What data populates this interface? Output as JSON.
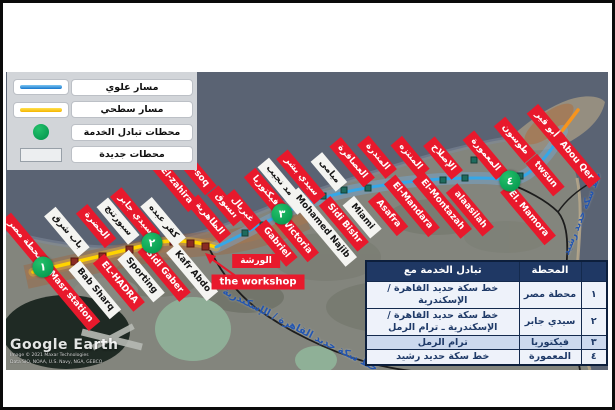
{
  "legend": {
    "items": [
      {
        "label": "مسار علوي",
        "symbol": "elevated-line"
      },
      {
        "label": "مسار سطحي",
        "symbol": "surface-line"
      },
      {
        "label": "محطات تبادل الخدمة",
        "symbol": "interchange-circle"
      },
      {
        "label": "محطات جديدة",
        "symbol": "new-station-box"
      }
    ]
  },
  "stations": [
    {
      "name_ar": "محطة مصر",
      "name_en": "Masr station",
      "type": "existing",
      "ar_pos": [
        19,
        169
      ],
      "en_pos": [
        64,
        225
      ]
    },
    {
      "name_ar": "باب شرق",
      "name_en": "Bab Sharq",
      "type": "new",
      "ar_pos": [
        61,
        160
      ],
      "en_pos": [
        89,
        218
      ]
    },
    {
      "name_ar": "الحضرة",
      "name_en": "EL-HADRA",
      "type": "existing",
      "ar_pos": [
        90,
        154
      ],
      "en_pos": [
        113,
        211
      ]
    },
    {
      "name_ar": "سبورتنج",
      "name_en": "Sporting",
      "type": "new",
      "ar_pos": [
        112,
        149
      ],
      "en_pos": [
        135,
        204
      ]
    },
    {
      "name_ar": "سيدي جابر",
      "name_en": "Sidi Gaber",
      "type": "existing",
      "ar_pos": [
        129,
        143
      ],
      "en_pos": [
        158,
        200
      ]
    },
    {
      "name_ar": "كفر عبده",
      "name_en": "Kafr Abdo",
      "type": "new",
      "ar_pos": [
        157,
        150
      ],
      "en_pos": [
        186,
        200
      ]
    },
    {
      "name_ar": "الظاهرية",
      "name_en": "El-zahira",
      "type": "existing",
      "ar_pos": [
        203,
        147
      ],
      "en_pos": [
        170,
        114
      ]
    },
    {
      "name_ar": "السوق",
      "name_en": "El-soq",
      "type": "existing",
      "ar_pos": [
        220,
        134
      ],
      "en_pos": [
        191,
        102
      ]
    },
    {
      "name_ar": "غبريال",
      "name_en": "Gabriel",
      "type": "existing",
      "ar_pos": [
        236,
        138
      ],
      "en_pos": [
        270,
        171
      ]
    },
    {
      "name_ar": "فيكتوريا",
      "name_en": "Victoria",
      "type": "existing",
      "ar_pos": [
        259,
        119
      ],
      "en_pos": [
        291,
        166
      ]
    },
    {
      "name_ar": "محمد نجيب",
      "name_en": "Mohamed Najib",
      "type": "new",
      "ar_pos": [
        277,
        114
      ],
      "en_pos": [
        316,
        155
      ]
    },
    {
      "name_ar": "سيدي بشر",
      "name_en": "Sidi Bishr",
      "type": "existing",
      "ar_pos": [
        295,
        105
      ],
      "en_pos": [
        338,
        152
      ]
    },
    {
      "name_ar": "ميامى",
      "name_en": "Miami",
      "type": "new",
      "ar_pos": [
        323,
        100
      ],
      "en_pos": [
        356,
        145
      ]
    },
    {
      "name_ar": "العصافرة",
      "name_en": "Asafra",
      "type": "existing",
      "ar_pos": [
        346,
        90
      ],
      "en_pos": [
        382,
        142
      ]
    },
    {
      "name_ar": "المندرة",
      "name_en": "El-Mandara",
      "type": "existing",
      "ar_pos": [
        371,
        85
      ],
      "en_pos": [
        406,
        134
      ]
    },
    {
      "name_ar": "المنتزه",
      "name_en": "El-Montazah",
      "type": "existing",
      "ar_pos": [
        404,
        85
      ],
      "en_pos": [
        436,
        133
      ]
    },
    {
      "name_ar": "الإصلاح",
      "name_en": "alaasilah",
      "type": "existing",
      "ar_pos": [
        437,
        86
      ],
      "en_pos": [
        464,
        138
      ]
    },
    {
      "name_ar": "المعمورة",
      "name_en": "El. Mamora",
      "type": "existing",
      "ar_pos": [
        479,
        83
      ],
      "en_pos": [
        522,
        142
      ]
    },
    {
      "name_ar": "طوسون",
      "name_en": "twsun",
      "type": "existing",
      "ar_pos": [
        509,
        68
      ],
      "en_pos": [
        539,
        103
      ]
    },
    {
      "name_ar": "أبو قير",
      "name_en": "Abou Qer",
      "type": "existing",
      "ar_pos": [
        540,
        53
      ],
      "en_pos": [
        570,
        89
      ]
    }
  ],
  "interchanges": [
    {
      "num": "١",
      "x": 37,
      "y": 195
    },
    {
      "num": "٢",
      "x": 146,
      "y": 171
    },
    {
      "num": "٣",
      "x": 276,
      "y": 142
    },
    {
      "num": "٤",
      "x": 504,
      "y": 109
    }
  ],
  "workshop": {
    "label_ar": "الورشة",
    "label_en": "the workshop"
  },
  "railway_labels": [
    {
      "text": "خط سكة حديد القاهرة / الإسكندرية"
    },
    {
      "text": "خط سكة حديد رشيد"
    }
  ],
  "table": {
    "header_interchange": "تبادل الخدمة مع",
    "header_station": "المحطة",
    "rows": [
      {
        "num": "١",
        "station": "محطة مصر",
        "interchange": "خط سكة حديد القاهرة / الإسكندرية"
      },
      {
        "num": "٢",
        "station": "سيدي جابر",
        "interchange": "خط سكة حديد القاهرة / الإسكندرية ـ ترام الرمل"
      },
      {
        "num": "٣",
        "station": "فيكتوريا",
        "interchange": "ترام الرمل"
      },
      {
        "num": "٤",
        "station": "المعمورة",
        "interchange": "خط سكة حديد رشيد"
      }
    ]
  },
  "watermark": {
    "brand": "Google Earth",
    "attribution1": "Image © 2021 Maxar Technologies",
    "attribution2": "Data SIO, NOAA, U.S. Navy, NGA, GEBCO"
  },
  "colors": {
    "elevated": "#35A7E8",
    "surface": "#FFD400",
    "orange_extension": "#F7941D",
    "interchange_green": "#00A651",
    "existing_red": "#E8192C",
    "new_white": "#F4F4F1",
    "table_header": "#1F3864"
  }
}
